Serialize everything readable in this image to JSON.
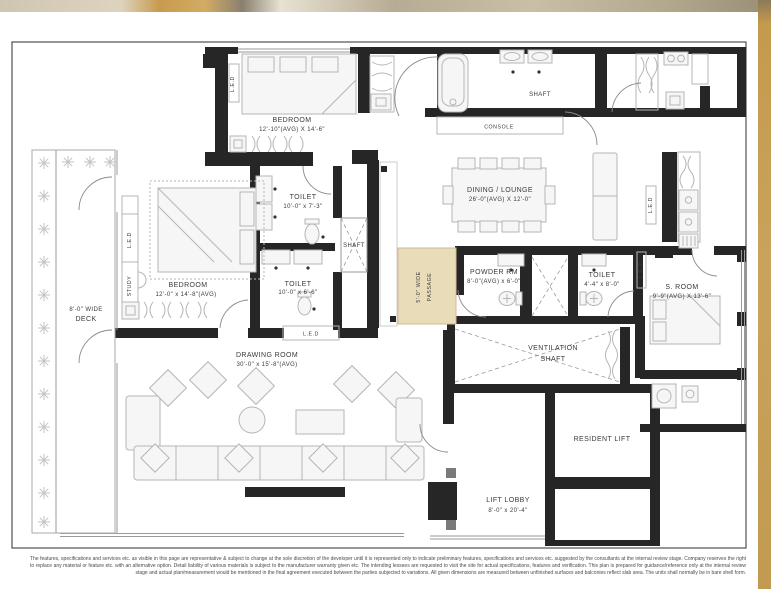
{
  "page": {
    "disclaimer": "The features, specifications and services etc. as visible in this page are representative & subject to change at the sole discretion of the developer until it is represented only to indicate preliminary features, specifications and services etc. suggested by the consultants at the internal review stage. Company reserves the right to replace any material or feature etc. with an alternative option. Detail liability of various materials is subject to the manufacturer warranty given etc. The intending lessees are requested to visit the site for actual specifications, features and verification. This plan is prepared for guidance/reference only at the internal review stage and actual plan/measurement would be mentioned in the final agreement executed between the parties subjected to variations. All given dimensions are measured between unfinished surfaces and balconies reflect slab area. The units shall normally be in bare shell form."
  },
  "plan": {
    "rooms": {
      "bedroom1": {
        "name": "BEDROOM",
        "dims": "12'-10\"(AVG) X 14'-6\""
      },
      "bedroom2": {
        "name": "BEDROOM",
        "dims": "12'-0\" x 14'-8\"(AVG)"
      },
      "toilet1": {
        "name": "TOILET",
        "dims": "10'-0\" x 7'-3\""
      },
      "toilet2": {
        "name": "TOILET",
        "dims": "10'-0\" x 6'-6\""
      },
      "toilet3": {
        "name": "TOILET",
        "dims": "4'-4\" x 8'-0\""
      },
      "powder": {
        "name": "POWDER RM",
        "dims": "8'-0\"(AVG) x 6'-0\""
      },
      "dining": {
        "name": "DINING / LOUNGE",
        "dims": "26'-0\"(AVG) X 12'-0\""
      },
      "drawing": {
        "name": "DRAWING ROOM",
        "dims": "30'-0\" x 15'-8\"(AVG)"
      },
      "sroom": {
        "name": "S. ROOM",
        "dims": "9'-9\"(AVG) X 13'-6\""
      },
      "deck": {
        "line1": "8'-0\" WIDE",
        "line2": "DECK"
      },
      "lift_lobby": {
        "name": "LIFT LOBBY",
        "dims": "8'-0\" x 20'-4\""
      },
      "resident_lift": {
        "name": "RESIDENT LIFT"
      },
      "vent_shaft": {
        "line1": "VENTILATION",
        "line2": "SHAFT"
      },
      "shaft_top": {
        "name": "SHAFT"
      },
      "shaft_mid": {
        "name": "SHAFT"
      },
      "console": {
        "name": "CONSOLE"
      },
      "passage": {
        "line1": "5'-0\" WIDE",
        "line2": "PASSAGE"
      },
      "study": {
        "name": "STUDY"
      },
      "led": {
        "name": "L.E.D"
      }
    },
    "colors": {
      "wall": "#262626",
      "passage": "#e9dcb8",
      "passage_border": "#cdbd92",
      "furn_fill": "#f6f6f6",
      "furn_stroke": "#b5b5b5",
      "text": "#3a3a3a",
      "frame": "#4f4f4f",
      "gold_edge": "#c29a52"
    }
  }
}
